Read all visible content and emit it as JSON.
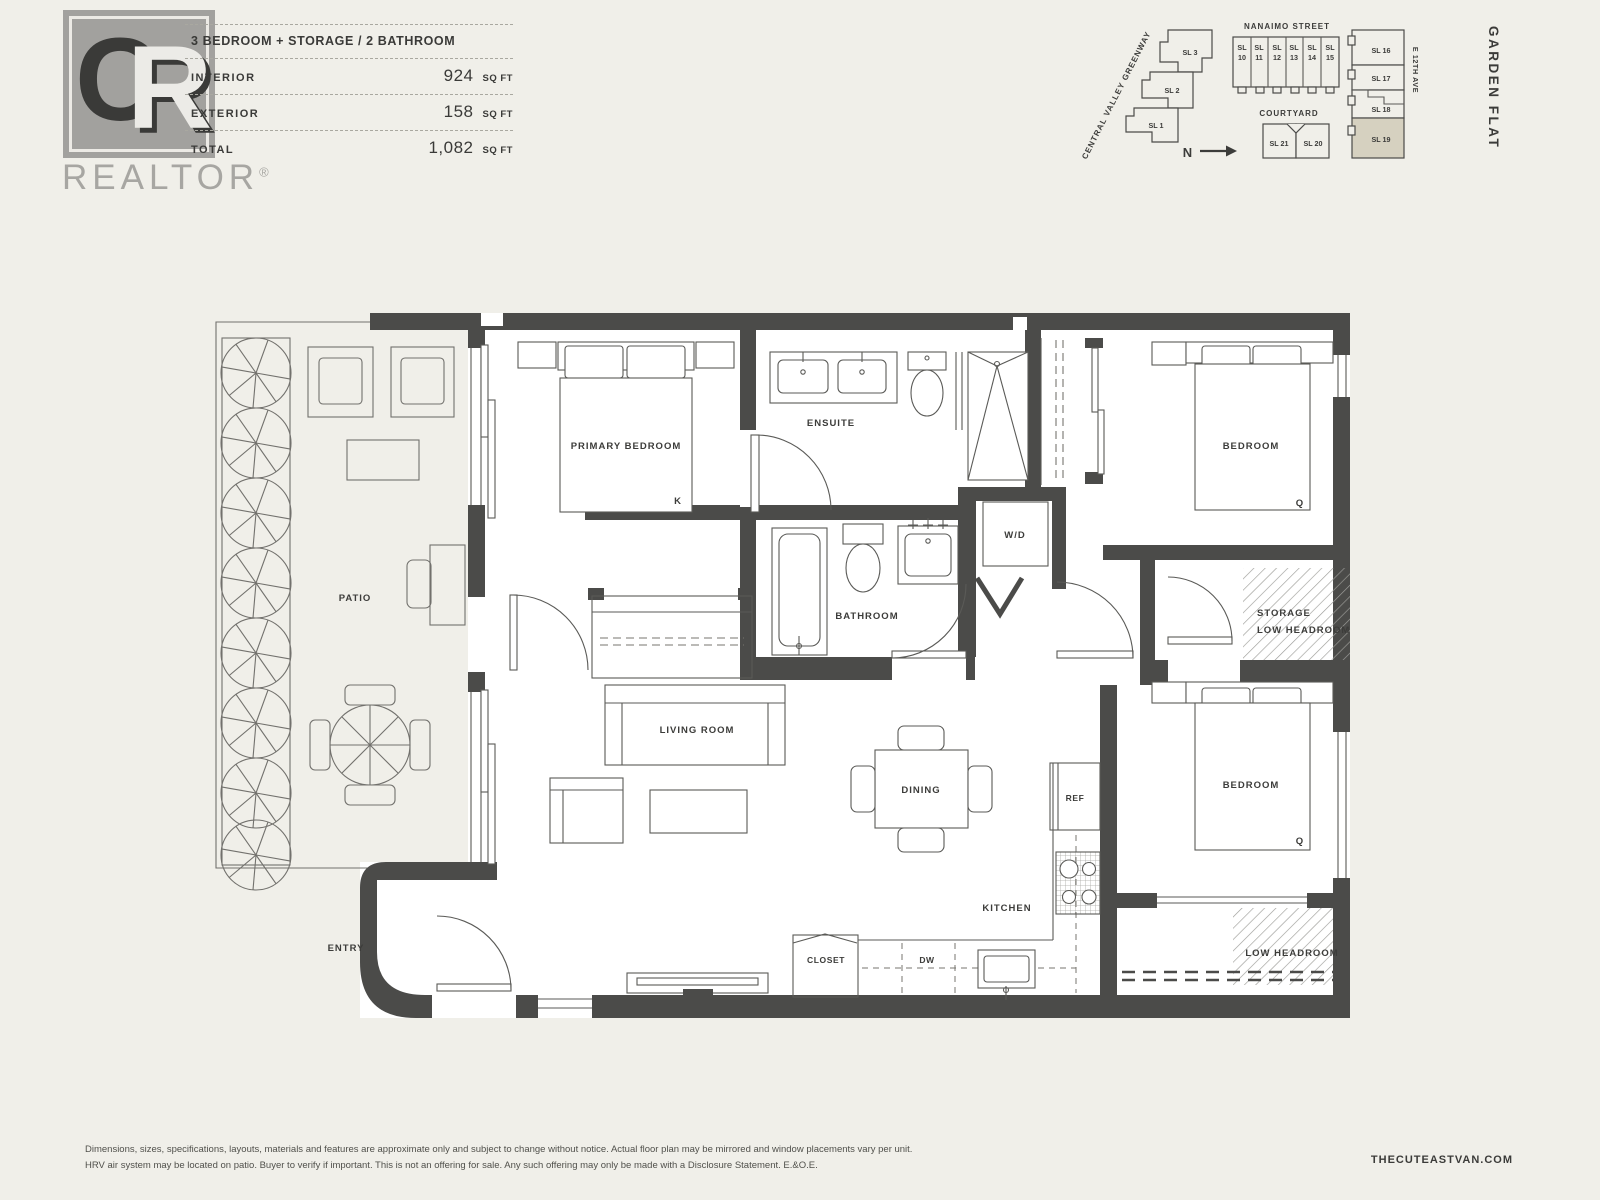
{
  "colors": {
    "page_bg": "#f0efe9",
    "wall": "#4b4b49",
    "highlight": "#d6d1c0"
  },
  "brand": {
    "monogram_c": "C",
    "monogram_r": "R",
    "wordmark": "REALTOR",
    "registered": "®"
  },
  "header": {
    "title": "3 BEDROOM + STORAGE / 2 BATHROOM",
    "rows": [
      {
        "label": "INTERIOR",
        "value": "924",
        "unit": "SQ FT"
      },
      {
        "label": "EXTERIOR",
        "value": "158",
        "unit": "SQ FT"
      },
      {
        "label": "TOTAL",
        "value": "1,082",
        "unit": "SQ FT"
      }
    ]
  },
  "side_label": "GARDEN FLAT",
  "site_map": {
    "nanaimo_street": "NANAIMO STREET",
    "greenway": "CENTRAL VALLEY GREENWAY",
    "courtyard": "COURTYARD",
    "e12th_ave": "E 12TH AVE",
    "north": "N",
    "sl_prefix": "SL",
    "strip_numbers": [
      "10",
      "11",
      "12",
      "13",
      "14",
      "15"
    ],
    "greenway_units": [
      "SL 3",
      "SL 2",
      "SL 1"
    ],
    "courtyard_units": [
      "SL 21",
      "SL 20"
    ],
    "right_units": [
      "SL 16",
      "SL 17",
      "SL 18",
      "SL 19"
    ],
    "highlighted_unit": "SL 19"
  },
  "plan": {
    "bed_king": "K",
    "bed_queen": "Q",
    "labels": {
      "patio": "PATIO",
      "primary_bedroom": "PRIMARY BEDROOM",
      "ensuite": "ENSUITE",
      "bedroom_upper": "BEDROOM",
      "bathroom": "BATHROOM",
      "wd": "W/D",
      "storage": "STORAGE",
      "storage_low_headroom": "LOW HEADROOM",
      "living_room": "LIVING ROOM",
      "dining": "DINING",
      "kitchen": "KITCHEN",
      "ref": "REF",
      "closet": "CLOSET",
      "dw": "DW",
      "entry": "ENTRY",
      "bedroom_lower": "BEDROOM",
      "low_headroom": "LOW HEADROOM"
    }
  },
  "footer": {
    "line1": "Dimensions, sizes, specifications, layouts, materials and features are approximate only and subject to change without notice. Actual floor plan may be mirrored and window placements vary per unit.",
    "line2": "HRV air system may be located on patio. Buyer to verify if important. This is not an offering for sale. Any such offering may only be made with a Disclosure Statement. E.&O.E.",
    "website": "THECUTEASTVAN.COM"
  }
}
